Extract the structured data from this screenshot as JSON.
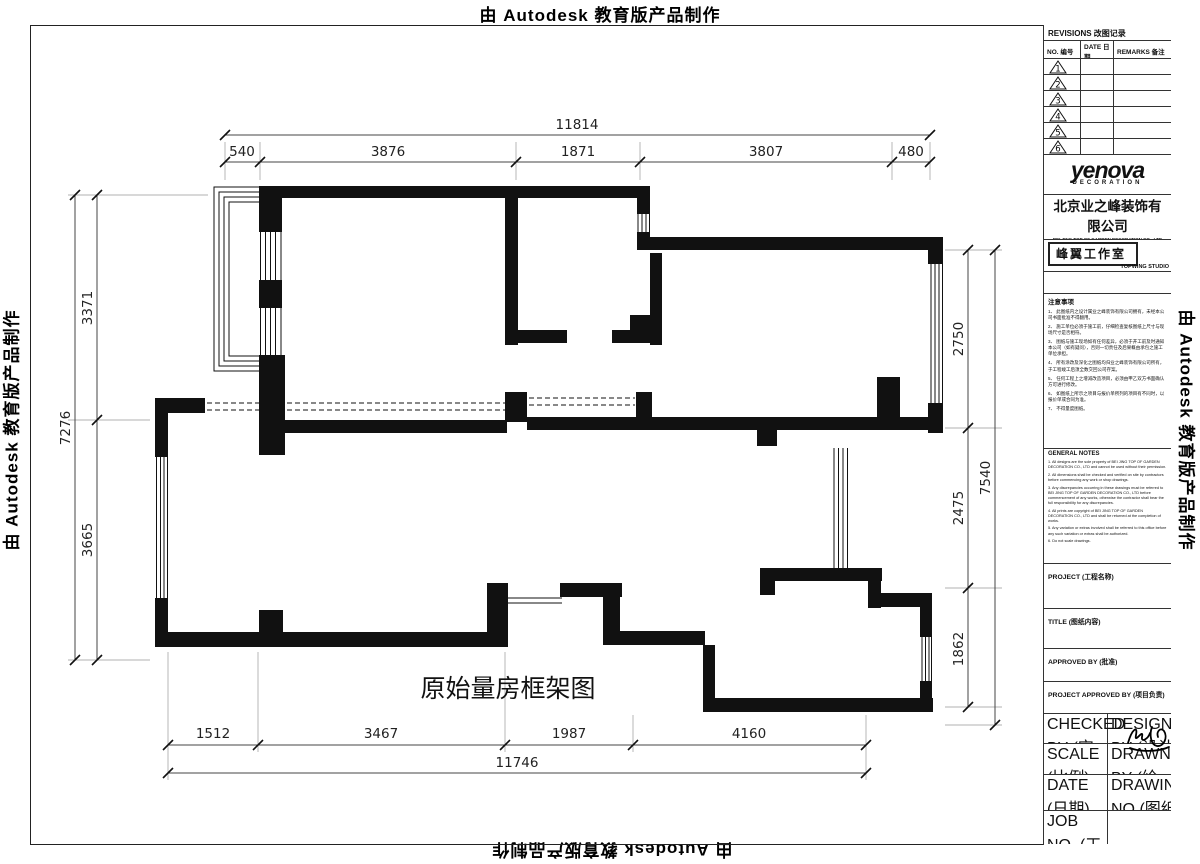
{
  "banner": {
    "text": "由 Autodesk 教育版产品制作"
  },
  "plan": {
    "title": "原始量房框架图",
    "dims": {
      "top": {
        "total": "11814",
        "segments": [
          "540",
          "3876",
          "1871",
          "3807",
          "480"
        ]
      },
      "left": {
        "total": "7276",
        "segments": [
          "3371",
          "3665"
        ]
      },
      "right": {
        "total": "7540",
        "segments": [
          "2750",
          "2475",
          "1862"
        ]
      },
      "bottom": {
        "total": "11746",
        "segments": [
          "1512",
          "3467",
          "1987",
          "4160"
        ]
      }
    }
  },
  "title_block": {
    "revisions": {
      "title": "REVISIONS 改图记录",
      "col_no": "NO. 编号",
      "col_date": "DATE 日期",
      "col_remarks": "REMARKS 备注",
      "rows": [
        "1",
        "2",
        "3",
        "4",
        "5",
        "6"
      ]
    },
    "logo": {
      "name": "yenova",
      "sub": "DECORATION"
    },
    "company": {
      "name": "北京业之峰装饰有限公司",
      "en": "BEI JING TOP OF GARDEN DECORATION CO., LTD",
      "cert": "国家室内装饰乙级施工企业 国家乙级设计资质单位"
    },
    "studio": {
      "name": "峰翼工作室",
      "en": "TOPWING STUDIO"
    },
    "notes_cn": {
      "heading": "注意事项",
      "items": [
        "1、 此图纸内之设计属业之峰装饰有限公司拥有，未经本公司书面批准不得翻用。",
        "2、 施工单位必须于施工前，仔细检查复核图纸上尺寸与现场尺寸是否相符。",
        "3、 图纸与施工现场如有任何差异，必须于开工前及时通知本公司（如有疑问），否则一切责任及后果概由承包之施工单位承担。",
        "4、 所有涂改及深化之图纸均归业之峰装饰有限公司所有，于工程竣工后须全数交回公司存案。",
        "5、 任何工程上之增减改造项目，必须由甲乙双方书面确认方可进行修改。",
        "6、 如图纸上所示之项目与报价单所列的项目有不同时，以报价单或合同为准。",
        "7、 不得量度图纸。"
      ]
    },
    "notes_en": {
      "heading": "GENERAL NOTES",
      "items": [
        "1. All designs are the sole property of BEI JING TOP OF GARDEN DECORATION CO., LTD and cannot be used without their permission.",
        "2. All dimensions shall be checked and verified on site by contractors before commencing any work or shop drawings.",
        "3. Any discrepancies occurring in these drawings must be referred to BEI JING TOP OF GARDEN DECORATION CO., LTD before commencement of any works, otherwise the contractor shall bear the full responsibility for any discrepancies.",
        "4. All prints are copyright of BEI JING TOP OF GARDEN DECORATION CO., LTD and shall be returned at the completion of works.",
        "5. Any variation or extras involved shall be referred to this office before any such variation or extras shall be authorized.",
        "6. Do not scale drawings."
      ]
    },
    "fields": {
      "project": "PROJECT (工程名称)",
      "title": "TITLE (图纸内容)",
      "approved": "APPROVED BY (批准)",
      "project_approved": "PROJECT APPROVED BY (项目负责)",
      "checked": "CHECKED BY (审核)",
      "designed": "DESIGNED BY (设计)",
      "scale": "SCALE (比例)",
      "drawn": "DRAWN BY (绘图)",
      "date": "DATE (日期)",
      "drawing_no": "DRAWING NO.(图纸编号)",
      "job_no": "JOB NO. (工程编号)"
    }
  }
}
